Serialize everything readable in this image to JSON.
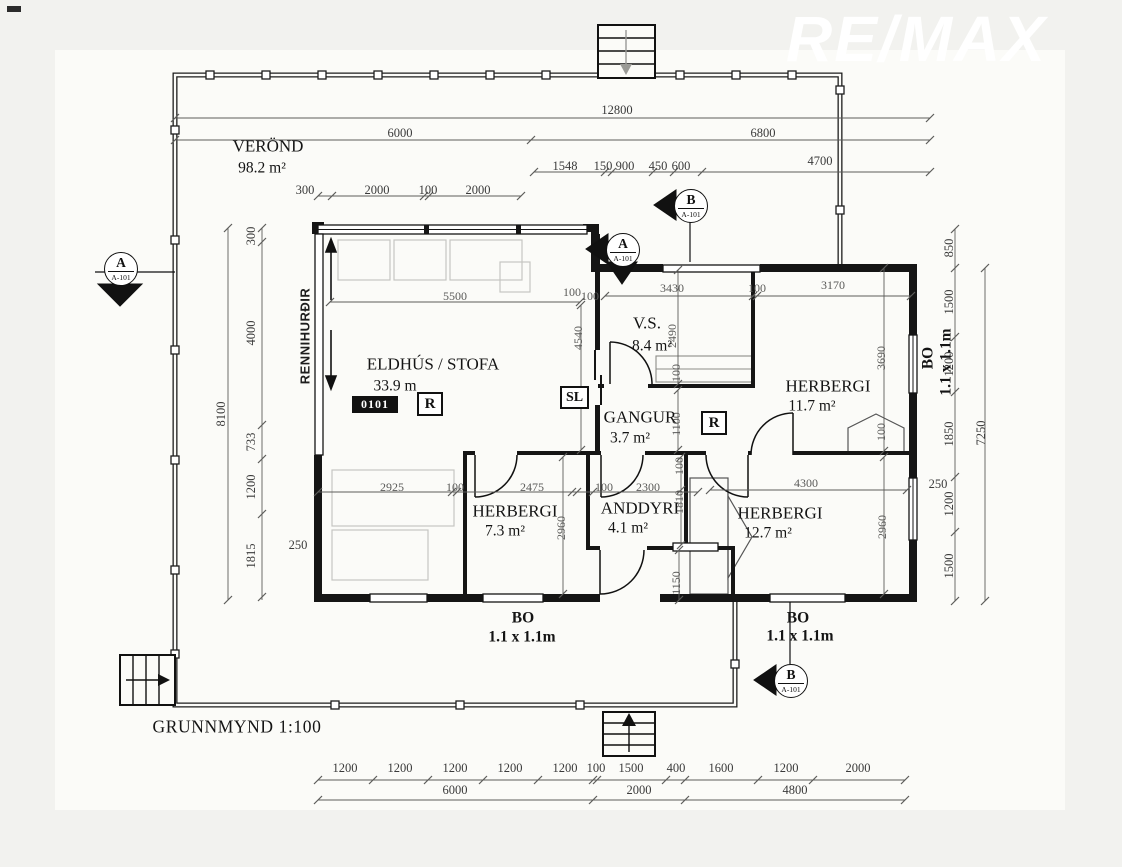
{
  "watermark": "RE/MAX",
  "title": "GRUNNMYND 1:100",
  "veranda": {
    "name": "VERÖND",
    "area": "98.2 m²"
  },
  "rooms": {
    "eldhus": {
      "name": "ELDHÚS / STOFA",
      "area": "33.9 m"
    },
    "vs": {
      "name": "V.S.",
      "area": "8.4 m²"
    },
    "herbergi1": {
      "name": "HERBERGI",
      "area": "11.7 m²"
    },
    "gangur": {
      "name": "GANGUR",
      "area": "3.7 m²"
    },
    "herbergi2": {
      "name": "HERBERGI",
      "area": "7.3 m²"
    },
    "anddyri": {
      "name": "ANDDYRI",
      "area": "4.1 m²"
    },
    "herbergi3": {
      "name": "HERBERGI",
      "area": "12.7 m²"
    }
  },
  "tags": {
    "room_id": "0101",
    "radiator": "R",
    "sliding": "SL",
    "renni": "RENNIHURÐIR"
  },
  "windows": {
    "bo_bottom_left": {
      "label": "BO",
      "size": "1.1 x 1.1m"
    },
    "bo_bottom_right": {
      "label": "BO",
      "size": "1.1 x 1.1m"
    },
    "bo_right": {
      "label": "BO",
      "size": "1.1 x 1.1m"
    }
  },
  "markers": {
    "a_left": {
      "letter": "A",
      "sheet": "A-101"
    },
    "a_mid": {
      "letter": "A",
      "sheet": "A-101"
    },
    "b_top": {
      "letter": "B",
      "sheet": "A-101"
    },
    "b_bottom": {
      "letter": "B",
      "sheet": "A-101"
    }
  },
  "dims": {
    "top": [
      "12800",
      "6000",
      "6800",
      "1548",
      "150",
      "900",
      "450",
      "600",
      "4700",
      "300",
      "2000",
      "100",
      "2000"
    ],
    "left": [
      "300",
      "4000",
      "733",
      "1200",
      "1815",
      "8100",
      "250"
    ],
    "right": [
      "850",
      "1500",
      "1200",
      "1850",
      "1200",
      "1500",
      "7250",
      "250"
    ],
    "bottom": [
      "1200",
      "1200",
      "1200",
      "1200",
      "1200",
      "100",
      "1500",
      "400",
      "1600",
      "1200",
      "2000",
      "6000",
      "2000",
      "4800"
    ],
    "inner": [
      "5500",
      "100",
      "3430",
      "100",
      "3170",
      "4540",
      "2490",
      "100",
      "3690",
      "100",
      "1100",
      "2925",
      "100",
      "2475",
      "100",
      "2300",
      "100",
      "1810",
      "4300",
      "2960",
      "2960",
      "1150",
      "100"
    ]
  }
}
